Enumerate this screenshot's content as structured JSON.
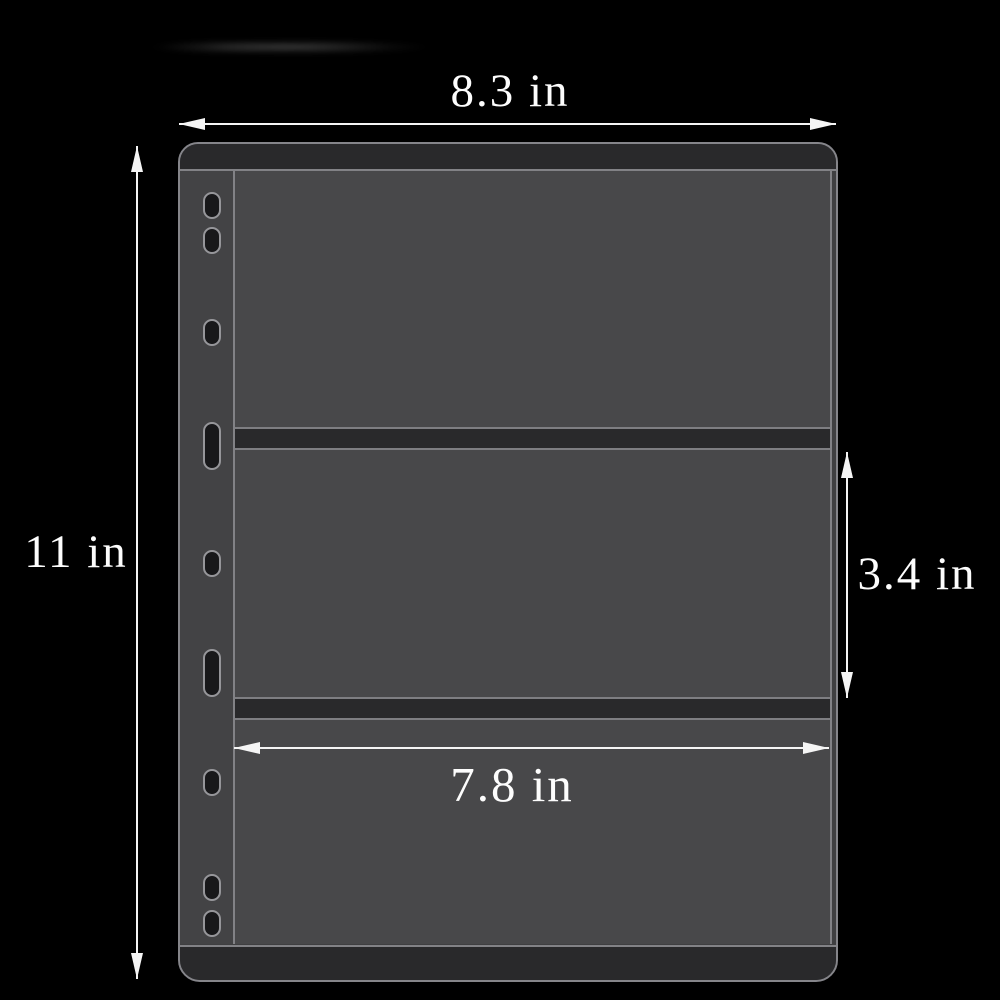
{
  "annotations": {
    "page_width_label": "8.3 in",
    "page_height_label": "11 in",
    "pocket_height_label": "3.4 in",
    "pocket_width_label": "7.8 in"
  },
  "product": {
    "pocket_count": 3,
    "binder_hole_count": 9
  },
  "colors": {
    "background": "#000000",
    "page_edge_line": "#85858a",
    "page_body": "#3f3f41",
    "hole_strip": "#434345",
    "pocket_interior": "#48484a",
    "dark_bands": "#29292b",
    "hole_fill": "#18181a",
    "dimension_lines": "#f5f5f5"
  }
}
